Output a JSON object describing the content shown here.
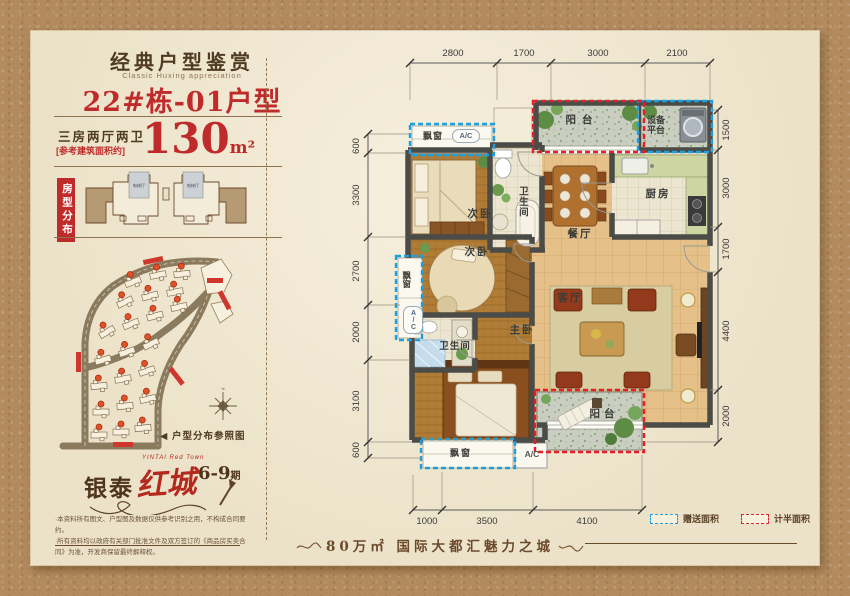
{
  "colors": {
    "accent_red": "#bf2b2b",
    "dash_blue": "#1fa0dc",
    "dash_red": "#e51e28",
    "paper": "#ece2c9",
    "kraft": "#b28a5e"
  },
  "panel": {
    "title": "经典户型鉴赏",
    "subtitle": "Classic Huxing appreciation",
    "unit_name": "22#栋-01户型",
    "layout_type": "三房两厅两卫",
    "area_note": "[参考建筑面积约]",
    "area_value": "130",
    "area_unit": "m²",
    "distribution_tag": "房型分布",
    "elevator_label": "电梯厅",
    "pointer_icon": "◀",
    "siteplan_caption": "户型分布参照图",
    "logo_brand": "银泰",
    "logo_name": "红城",
    "logo_phase": "6-9",
    "logo_phase_suffix": "期",
    "logo_en": "YINTAI Red Town",
    "disclaimer_line1": "·本资料所有图文、户型图及数据仅供参考识别之用，不构成合同要约。",
    "disclaimer_line2": "·所有资料均以政府有关部门批准文件及双方签订的《商品房买卖合同》为准，开发商保留最终解释权。"
  },
  "floorplan": {
    "rooms": {
      "balcony_top": "阳台",
      "equipment_platform": "设备平台",
      "kitchen": "厨房",
      "dining": "餐厅",
      "living": "客厅",
      "bedroom_a": "次卧",
      "bedroom_b": "次卧",
      "master": "主卧",
      "bath_a": "卫生间",
      "bath_b": "卫生间",
      "balcony_bottom": "阳台",
      "bay_top": "飘窗",
      "bay_left": "飘窗",
      "bay_bottom": "飘窗",
      "ac": "A/C"
    },
    "dims": {
      "top": [
        "2800",
        "1700",
        "3000",
        "2100"
      ],
      "left": [
        "600",
        "3300",
        "2700",
        "2000",
        "3100",
        "600"
      ],
      "right": [
        "1500",
        "3000",
        "1700",
        "4400",
        "2000"
      ],
      "bottom": [
        "1000",
        "3500",
        "4100"
      ]
    },
    "legend": {
      "gift": "赠送面积",
      "half": "计半面积"
    }
  },
  "footer": {
    "slogan": "80万㎡ 国际大都汇魅力之城"
  }
}
